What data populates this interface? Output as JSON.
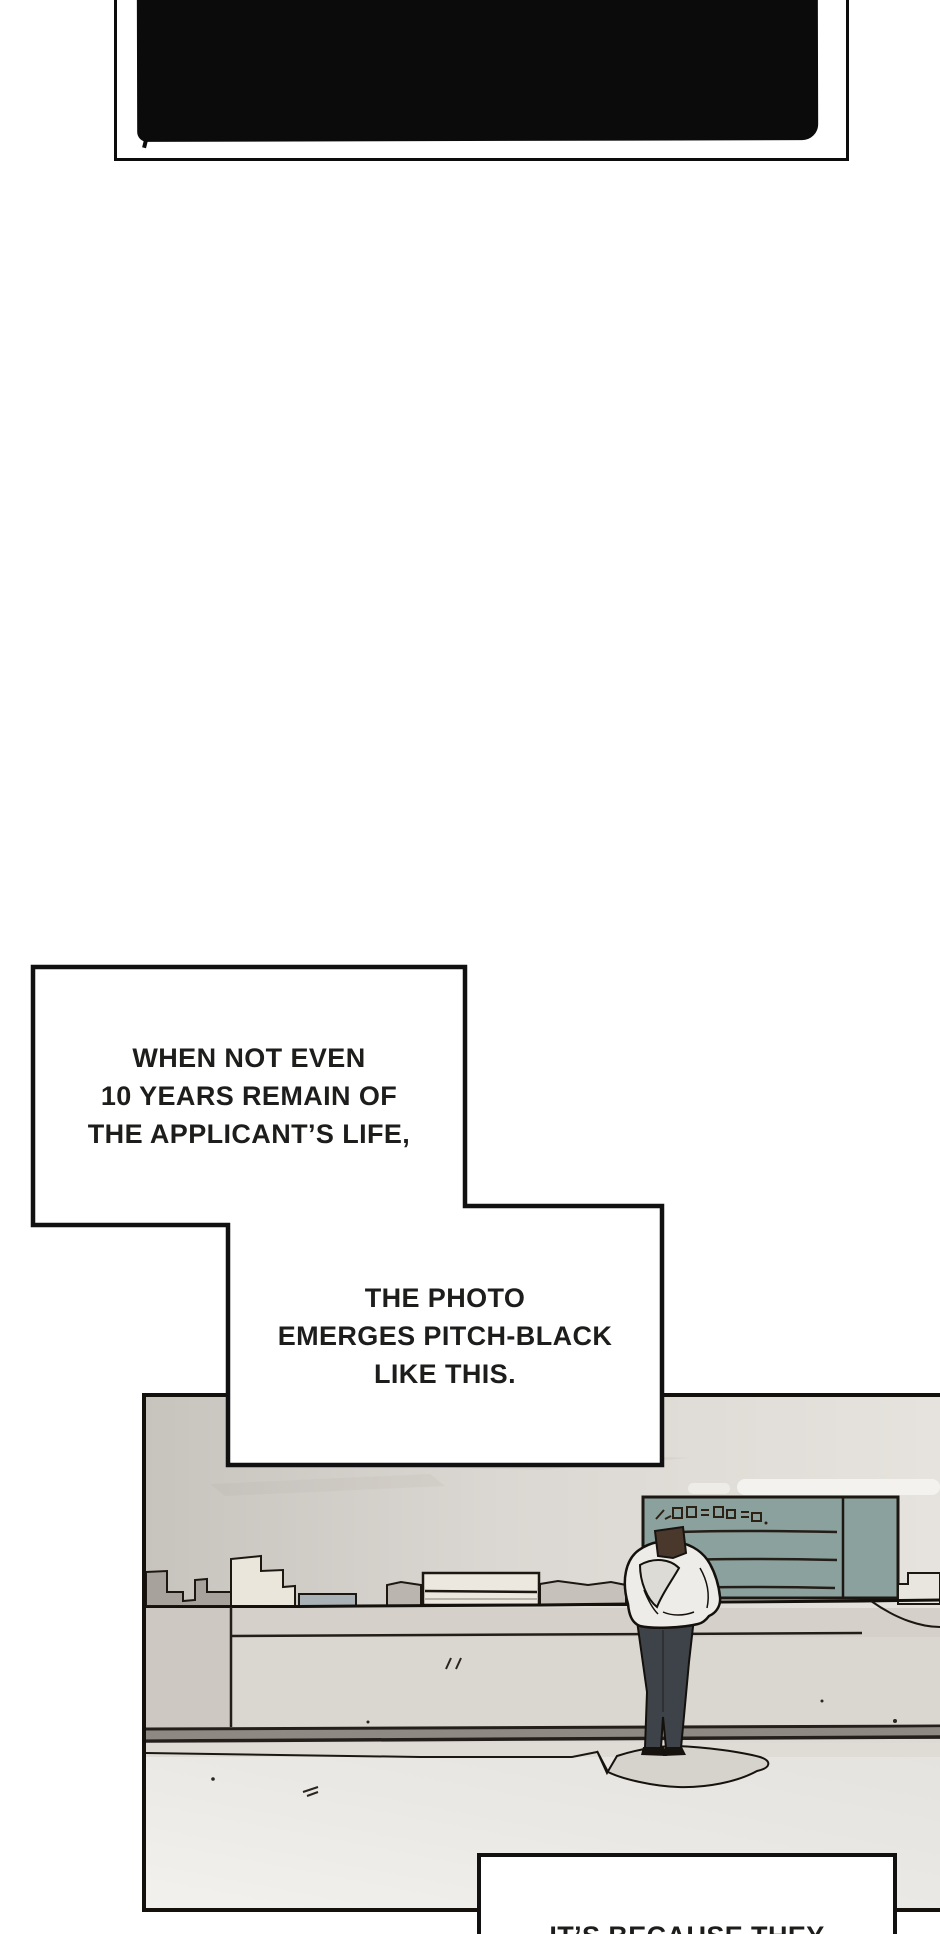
{
  "page": {
    "kind": "webtoon comic page",
    "width": 940,
    "height": 1934,
    "background": "#ffffff"
  },
  "photo": {
    "description": "developed photo that came out entirely black, inside hand-drawn frame",
    "fill": "#0b0b0b"
  },
  "bubbles": {
    "b1": {
      "l1": "WHEN NOT EVEN",
      "l2": "10 YEARS REMAIN OF",
      "l3": "THE APPLICANT’S LIFE,"
    },
    "b2": {
      "l1": "THE PHOTO",
      "l2": "EMERGES PITCH-BLACK",
      "l3": "LIKE THIS."
    },
    "b3": {
      "l1": "IT’S BECAUSE THEY"
    }
  },
  "palette": {
    "ink": "#14100c",
    "photo_black": "#0b0b0b",
    "wall": "#dbd7d2",
    "board": "#8ba19e",
    "counter_face": "#d5d1ca",
    "counter_face_lower": "#dad6d0",
    "counter_left": "#cdc9c2",
    "floor": "#eae8e4",
    "shadow": "#d6d3cd",
    "item_dark": "#a7a39c",
    "item_cream": "#eae6dc",
    "item_blue": "#a9b2b6",
    "item_gray": "#bab6af",
    "item_tray": "#ece8df",
    "item_wavy": "#c6c2bb",
    "shelf": "#e9e6df",
    "jacket": "#edece8",
    "jacket_shade": "#dcdbd5",
    "pants": "#3e434a",
    "hair": "#4b382d",
    "skin": "#c39b82"
  }
}
